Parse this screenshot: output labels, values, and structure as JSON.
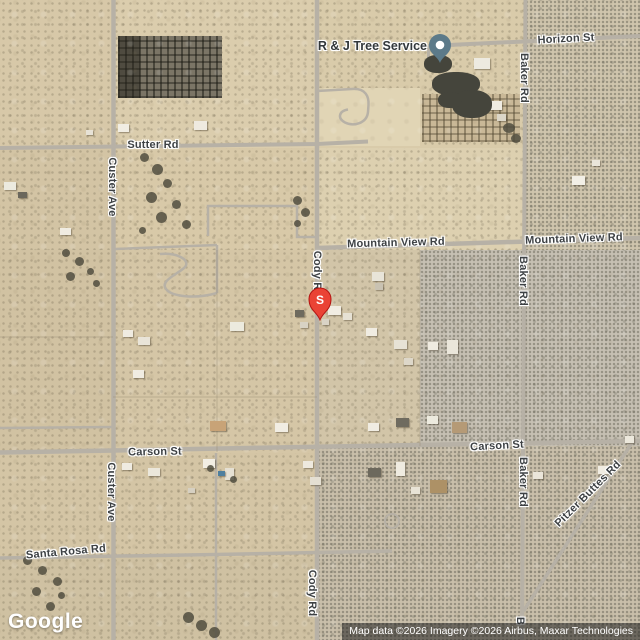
{
  "map": {
    "road_labels": {
      "horizon": "Horizon St",
      "sutter": "Sutter Rd",
      "custer_top": "Custer Ave",
      "custer_bottom": "Custer Ave",
      "mountain_view_left": "Mountain View Rd",
      "mountain_view_right": "Mountain View Rd",
      "baker_top": "Baker Rd",
      "baker_mid": "Baker Rd",
      "baker_lower": "Baker Rd",
      "baker_partial": "B",
      "cody_upper": "Cody Rd",
      "cody_lower": "Cody Rd",
      "carson_left": "Carson St",
      "carson_right": "Carson St",
      "santa_rosa": "Santa Rosa Rd",
      "pitzer": "Pitzer Buttes Rd"
    },
    "poi": {
      "business_label": "R & J Tree Service",
      "marker_letter": "S"
    },
    "branding": {
      "logo": "Google"
    },
    "attribution": "Map data ©2026 Imagery ©2026 Airbus, Maxar Technologies",
    "colors": {
      "road": "#b7b1a6",
      "label_text": "#3d4144",
      "red_marker": "#ea4335",
      "red_marker_border": "#b31412",
      "poi_marker": "#5c7a89",
      "attribution_bg": "rgba(33,33,33,0.55)"
    }
  }
}
